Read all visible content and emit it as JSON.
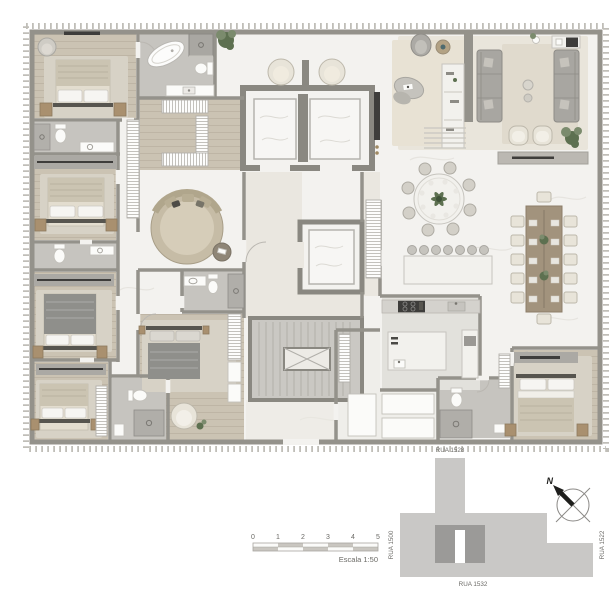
{
  "scale_bar": {
    "ticks": [
      "0",
      "1",
      "2",
      "3",
      "4",
      "5"
    ],
    "label": "Escala 1:50"
  },
  "site_plan": {
    "street_top": "RUA 1528",
    "street_left": "RUA 1500",
    "street_bottom": "RUA 1532",
    "street_right": "RUA 1522",
    "north_label": "N"
  },
  "colors": {
    "wall": "#94928b",
    "wallcore": "#8a8881",
    "marble": "#f3f2ef",
    "wood": "#cbc3b3",
    "bath": "#c6c4bf",
    "hall": "#eae7e0",
    "kitchen": "#e2e1dc",
    "rug": "#d7d2c6",
    "rugliving": "#e9e5db",
    "furn": "#aba9a4",
    "furnlight": "#f2f1ed",
    "cream": "#e8e4d9",
    "dark": "#3e3d3b",
    "nightstand": "#a9906f",
    "duvtan": "#cbc4b2",
    "duvdark": "#8f8f8b",
    "plant": "#5d7050",
    "plantlight": "#7b8b6d",
    "sitelight": "#c9c8c6",
    "sitedark": "#9b9a98",
    "tickborder": "#c0beb8",
    "textcol": "#6b6a66"
  }
}
